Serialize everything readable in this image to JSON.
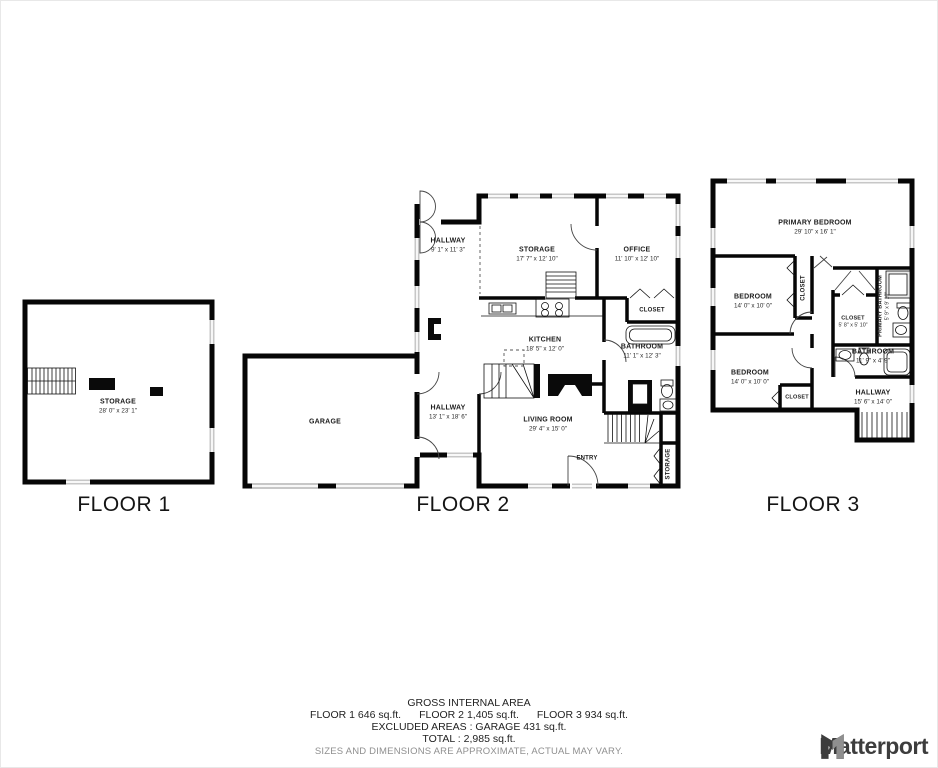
{
  "floors": [
    {
      "label": "FLOOR 1",
      "rooms": [
        {
          "name": "STORAGE",
          "dims": "28' 0\" x 23' 1\""
        }
      ]
    },
    {
      "label": "FLOOR 2",
      "rooms": [
        {
          "name": "HALLWAY",
          "dims": "9' 1\" x 11' 3\""
        },
        {
          "name": "STORAGE",
          "dims": "17' 7\" x 12' 10\""
        },
        {
          "name": "OFFICE",
          "dims": "11' 10\" x 12' 10\""
        },
        {
          "name": "CLOSET"
        },
        {
          "name": "KITCHEN",
          "dims": "18' 5\" x 12' 0\""
        },
        {
          "name": "BATHROOM",
          "dims": "11' 1\" x 12' 3\""
        },
        {
          "name": "GARAGE"
        },
        {
          "name": "HALLWAY",
          "dims": "13' 1\" x 18' 6\""
        },
        {
          "name": "LIVING ROOM",
          "dims": "29' 4\" x 15' 0\""
        },
        {
          "name": "ENTRY"
        },
        {
          "name": "STORAGE"
        }
      ]
    },
    {
      "label": "FLOOR 3",
      "rooms": [
        {
          "name": "PRIMARY BEDROOM",
          "dims": "29' 10\" x 16' 1\""
        },
        {
          "name": "BEDROOM",
          "dims": "14' 0\" x 10' 0\""
        },
        {
          "name": "CLOSET"
        },
        {
          "name": "CLOSET",
          "dims": "5' 8\" x 5' 10\""
        },
        {
          "name": "PRIMARY BATHROOM",
          "dims": "5' 9\" x 9' 10\""
        },
        {
          "name": "BATHROOM",
          "dims": "11' 9\" x 4' 9\""
        },
        {
          "name": "BEDROOM",
          "dims": "14' 0\" x 10' 0\""
        },
        {
          "name": "CLOSET"
        },
        {
          "name": "HALLWAY",
          "dims": "15' 6\" x 14' 0\""
        }
      ]
    }
  ],
  "summary": {
    "title": "GROSS INTERNAL AREA",
    "floor_areas": [
      "FLOOR 1 646 sq.ft.",
      "FLOOR 2 1,405 sq.ft.",
      "FLOOR 3 934 sq.ft."
    ],
    "excluded": "EXCLUDED AREAS :  GARAGE 431 sq.ft.",
    "total": "TOTAL :  2,985 sq.ft.",
    "disclaimer": "SIZES AND DIMENSIONS ARE APPROXIMATE, ACTUAL MAY VARY."
  },
  "branding": {
    "logo_text": "Matterport"
  },
  "colors": {
    "wall": "#060606",
    "window": "#c7c7c7",
    "text": "#1c1c1c",
    "muted": "#8f8f8f",
    "logo": "#3d3d3d"
  }
}
